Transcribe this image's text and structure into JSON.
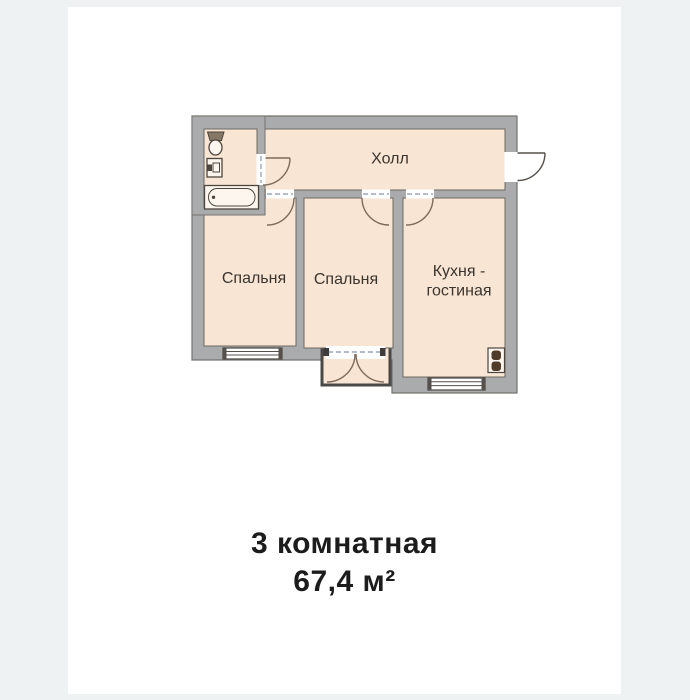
{
  "page": {
    "background_color": "#eff2f2",
    "card_color": "#ffffff"
  },
  "floor_plan": {
    "rooms": {
      "hall": {
        "label": "Холл"
      },
      "bedroom_1": {
        "label": "Спальня"
      },
      "bedroom_2": {
        "label": "Спальня"
      },
      "kitchen_living": {
        "label_line_1": "Кухня -",
        "label_line_2": "гостиная"
      }
    },
    "icons": {
      "toilet": "toilet-icon",
      "sink": "sink-icon",
      "bathtub": "bathtub-icon",
      "stove": "stove-icon"
    },
    "colors": {
      "walls": "#a9abad",
      "wall_outline": "#76736f",
      "room_fill": "#f8e5d3",
      "room_outline": "#6e6861",
      "door_arc": "#7d6b5c",
      "opening_dash": "#9aa7bb",
      "balcony_outline": "#4b4947",
      "fixture_outline": "#4c463f",
      "label_text": "#3a352f"
    }
  },
  "caption": {
    "line_1": "3 комнатная",
    "line_2": "67,4 м²",
    "text_color": "#1c1c1c"
  }
}
